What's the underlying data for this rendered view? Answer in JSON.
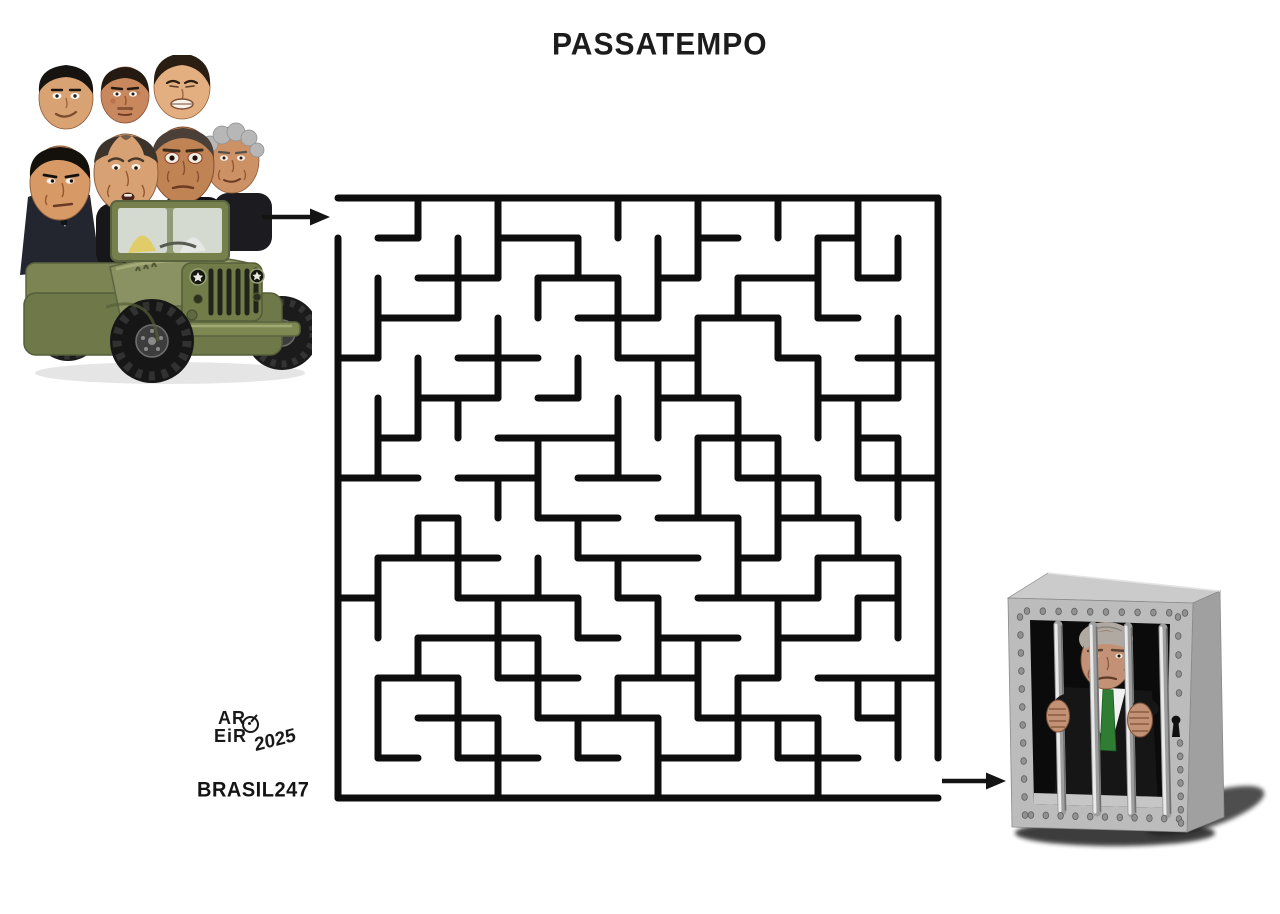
{
  "title": "PASSATEMPO",
  "signature": {
    "line1": "AR",
    "line2": "EiR",
    "year": "2025",
    "brand": "BRASIL247"
  },
  "colors": {
    "background": "#ffffff",
    "maze_line": "#0d0d0d",
    "arrow": "#141414",
    "jeep_olive": "#8a9162",
    "jeep_olive_dark": "#5c6540",
    "jeep_olive_light": "#a9b07c",
    "cage_gray": "#bcbcbc",
    "cage_gray_dark": "#a0a0a0",
    "cage_gray_top": "#cbcbcb",
    "tie_green": "#2e7d32",
    "skin": "#d1976b"
  },
  "icons": {
    "entry_arrow": "right-arrow-icon",
    "exit_arrow": "right-arrow-icon",
    "keyhole": "keyhole-icon"
  },
  "scene": {
    "jeep_heads": 7,
    "prisoner": "caricature-behind-bars",
    "jail_bars": 4
  },
  "jail": {
    "rivets": {
      "top": 11,
      "bottom": 11,
      "left": 12,
      "right": 12
    }
  },
  "maze": {
    "cols": 15,
    "rows": 15,
    "cell": 40,
    "pad": 20,
    "stroke": 7,
    "entrance": "left-top",
    "exit": "right-bottom",
    "h_walls": [
      [
        0,
        0,
        15
      ],
      [
        15,
        0,
        15
      ],
      [
        1,
        1,
        2
      ],
      [
        1,
        4,
        6
      ],
      [
        1,
        9,
        10
      ],
      [
        1,
        12,
        13
      ],
      [
        2,
        2,
        4
      ],
      [
        2,
        5,
        7
      ],
      [
        2,
        8,
        9
      ],
      [
        2,
        10,
        12
      ],
      [
        2,
        13,
        14
      ],
      [
        3,
        1,
        3
      ],
      [
        3,
        6,
        8
      ],
      [
        3,
        9,
        11
      ],
      [
        3,
        12,
        13
      ],
      [
        4,
        0,
        1
      ],
      [
        4,
        3,
        5
      ],
      [
        4,
        7,
        9
      ],
      [
        4,
        11,
        12
      ],
      [
        4,
        13,
        15
      ],
      [
        5,
        2,
        4
      ],
      [
        5,
        5,
        6
      ],
      [
        5,
        8,
        10
      ],
      [
        5,
        12,
        14
      ],
      [
        6,
        1,
        2
      ],
      [
        6,
        4,
        7
      ],
      [
        6,
        9,
        11
      ],
      [
        6,
        13,
        14
      ],
      [
        7,
        0,
        2
      ],
      [
        7,
        3,
        5
      ],
      [
        7,
        6,
        8
      ],
      [
        7,
        10,
        12
      ],
      [
        7,
        13,
        15
      ],
      [
        8,
        2,
        3
      ],
      [
        8,
        5,
        7
      ],
      [
        8,
        8,
        10
      ],
      [
        8,
        11,
        13
      ],
      [
        9,
        1,
        4
      ],
      [
        9,
        6,
        9
      ],
      [
        9,
        10,
        11
      ],
      [
        9,
        12,
        14
      ],
      [
        10,
        0,
        1
      ],
      [
        10,
        3,
        6
      ],
      [
        10,
        7,
        8
      ],
      [
        10,
        9,
        12
      ],
      [
        10,
        13,
        14
      ],
      [
        11,
        2,
        5
      ],
      [
        11,
        6,
        7
      ],
      [
        11,
        8,
        10
      ],
      [
        11,
        11,
        13
      ],
      [
        12,
        1,
        3
      ],
      [
        12,
        4,
        6
      ],
      [
        12,
        7,
        9
      ],
      [
        12,
        10,
        11
      ],
      [
        12,
        12,
        15
      ],
      [
        13,
        2,
        4
      ],
      [
        13,
        5,
        8
      ],
      [
        13,
        9,
        12
      ],
      [
        13,
        13,
        14
      ],
      [
        14,
        1,
        2
      ],
      [
        14,
        3,
        5
      ],
      [
        14,
        6,
        7
      ],
      [
        14,
        8,
        10
      ],
      [
        14,
        11,
        13
      ]
    ],
    "v_walls": [
      [
        0,
        1,
        15
      ],
      [
        15,
        0,
        14
      ],
      [
        1,
        2,
        4
      ],
      [
        1,
        5,
        7
      ],
      [
        1,
        9,
        11
      ],
      [
        1,
        12,
        14
      ],
      [
        2,
        0,
        1
      ],
      [
        2,
        4,
        6
      ],
      [
        2,
        8,
        9
      ],
      [
        2,
        11,
        12
      ],
      [
        3,
        1,
        3
      ],
      [
        3,
        5,
        6
      ],
      [
        3,
        8,
        10
      ],
      [
        3,
        12,
        14
      ],
      [
        4,
        0,
        2
      ],
      [
        4,
        3,
        5
      ],
      [
        4,
        7,
        8
      ],
      [
        4,
        10,
        12
      ],
      [
        4,
        13,
        15
      ],
      [
        5,
        2,
        3
      ],
      [
        5,
        6,
        8
      ],
      [
        5,
        9,
        10
      ],
      [
        5,
        11,
        13
      ],
      [
        6,
        1,
        2
      ],
      [
        6,
        4,
        5
      ],
      [
        6,
        8,
        9
      ],
      [
        6,
        10,
        11
      ],
      [
        6,
        13,
        14
      ],
      [
        7,
        0,
        1
      ],
      [
        7,
        2,
        4
      ],
      [
        7,
        5,
        7
      ],
      [
        7,
        9,
        10
      ],
      [
        7,
        12,
        13
      ],
      [
        8,
        1,
        3
      ],
      [
        8,
        4,
        6
      ],
      [
        8,
        10,
        12
      ],
      [
        8,
        13,
        15
      ],
      [
        9,
        0,
        2
      ],
      [
        9,
        3,
        5
      ],
      [
        9,
        6,
        8
      ],
      [
        9,
        11,
        13
      ],
      [
        10,
        2,
        3
      ],
      [
        10,
        5,
        7
      ],
      [
        10,
        8,
        10
      ],
      [
        10,
        12,
        14
      ],
      [
        11,
        0,
        1
      ],
      [
        11,
        3,
        4
      ],
      [
        11,
        6,
        9
      ],
      [
        11,
        10,
        12
      ],
      [
        11,
        13,
        14
      ],
      [
        12,
        1,
        3
      ],
      [
        12,
        4,
        6
      ],
      [
        12,
        7,
        8
      ],
      [
        12,
        9,
        10
      ],
      [
        12,
        13,
        15
      ],
      [
        13,
        0,
        2
      ],
      [
        13,
        5,
        7
      ],
      [
        13,
        8,
        9
      ],
      [
        13,
        10,
        11
      ],
      [
        13,
        12,
        13
      ],
      [
        14,
        1,
        2
      ],
      [
        14,
        3,
        5
      ],
      [
        14,
        6,
        8
      ],
      [
        14,
        9,
        11
      ],
      [
        14,
        12,
        14
      ]
    ]
  }
}
